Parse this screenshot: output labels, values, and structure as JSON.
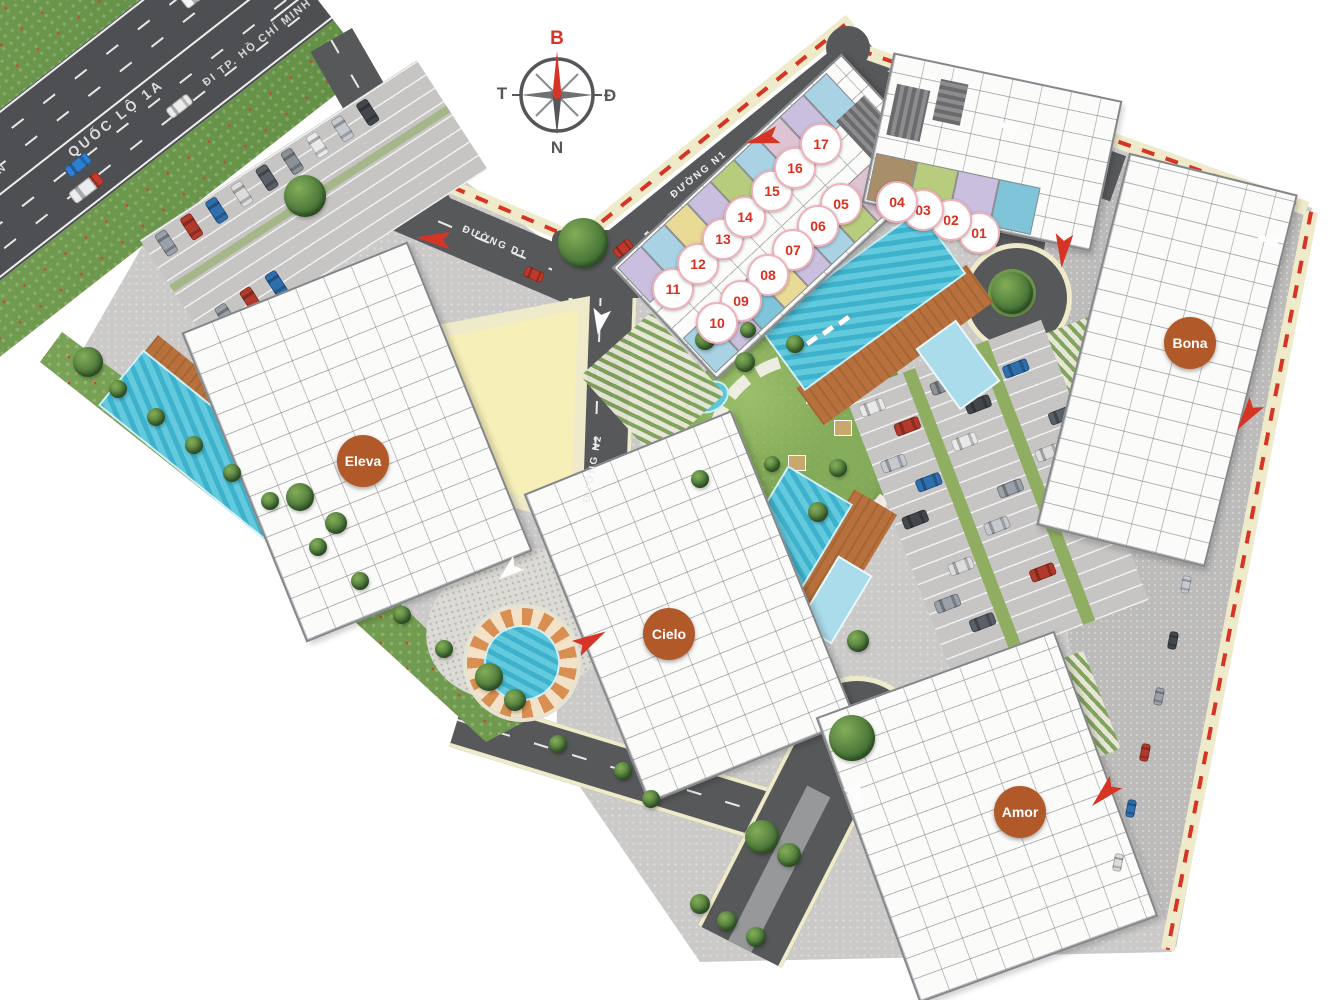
{
  "page": {
    "type": "residential master-plan site map",
    "background": "#ffffff"
  },
  "compass": {
    "north_label": "B",
    "east_label": "Đ",
    "west_label": "T",
    "south_label": "N",
    "north_color": "#D63425"
  },
  "roads": {
    "highway_name": "QUỐC LỘ 1A",
    "highway_direction_label": "ĐI TP. HỒ CHÍ MINH",
    "edge_partial_label": "N",
    "road_d1_label": "ĐƯỜNG D1",
    "road_n1_label": "ĐƯỜNG N1",
    "road_n2_label": "ĐƯỜNG N2"
  },
  "towers": {
    "eleva": "Eleva",
    "cielo": "Cielo",
    "bona": "Bona",
    "amor": "Amor"
  },
  "units": {
    "u01": "01",
    "u02": "02",
    "u03": "03",
    "u04": "04",
    "u05": "05",
    "u06": "06",
    "u07": "07",
    "u08": "08",
    "u09": "09",
    "u10": "10",
    "u11": "11",
    "u12": "12",
    "u13": "13",
    "u14": "14",
    "u15": "15",
    "u16": "16",
    "u17": "17"
  },
  "legend_colors": {
    "boundary_red": "#D63425",
    "tower_badge_orange": "#B2592A",
    "unit_number_red": "#D9301F",
    "unit_ring_pink": "#EFB2BA",
    "road_gray": "#57585A",
    "sidewalk_cream": "#EEEACA",
    "water_blue": "#52C2D8",
    "landscape_green": "#7CA455",
    "paving_gray": "#C9C8C7"
  }
}
